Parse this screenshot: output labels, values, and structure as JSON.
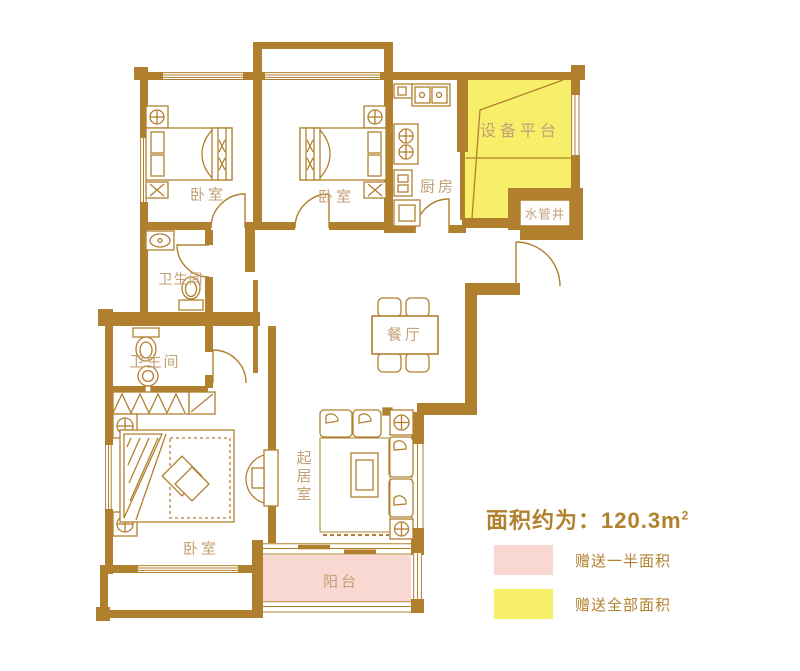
{
  "plan": {
    "rooms": {
      "bedroom1": {
        "label": "卧室"
      },
      "bedroom2": {
        "label": "卧室"
      },
      "master_bedroom": {
        "label": "卧室"
      },
      "kitchen": {
        "label": "厨房"
      },
      "equipment_platform": {
        "label": "设备平台"
      },
      "water_pipe_shaft": {
        "label": "水管井"
      },
      "dining_room": {
        "label": "餐厅"
      },
      "bathroom_upper": {
        "label": "卫生间"
      },
      "bathroom_lower": {
        "label": "卫生间"
      },
      "living_room": {
        "label": "起居室"
      },
      "balcony": {
        "label": "阳台"
      }
    },
    "colors": {
      "wall": "#B1802E",
      "room_label_text": "#C4A076",
      "half_area_fill": "#FAD8D2",
      "full_area_fill": "#F7EE6A",
      "legend_text": "#B2812E"
    }
  },
  "legend": {
    "area_title": "面积约为：120.3m",
    "area_sup": "2",
    "items": [
      {
        "label": "赠送一半面积",
        "color": "#FAD8D2"
      },
      {
        "label": "赠送全部面积",
        "color": "#F7EE6A"
      }
    ]
  }
}
